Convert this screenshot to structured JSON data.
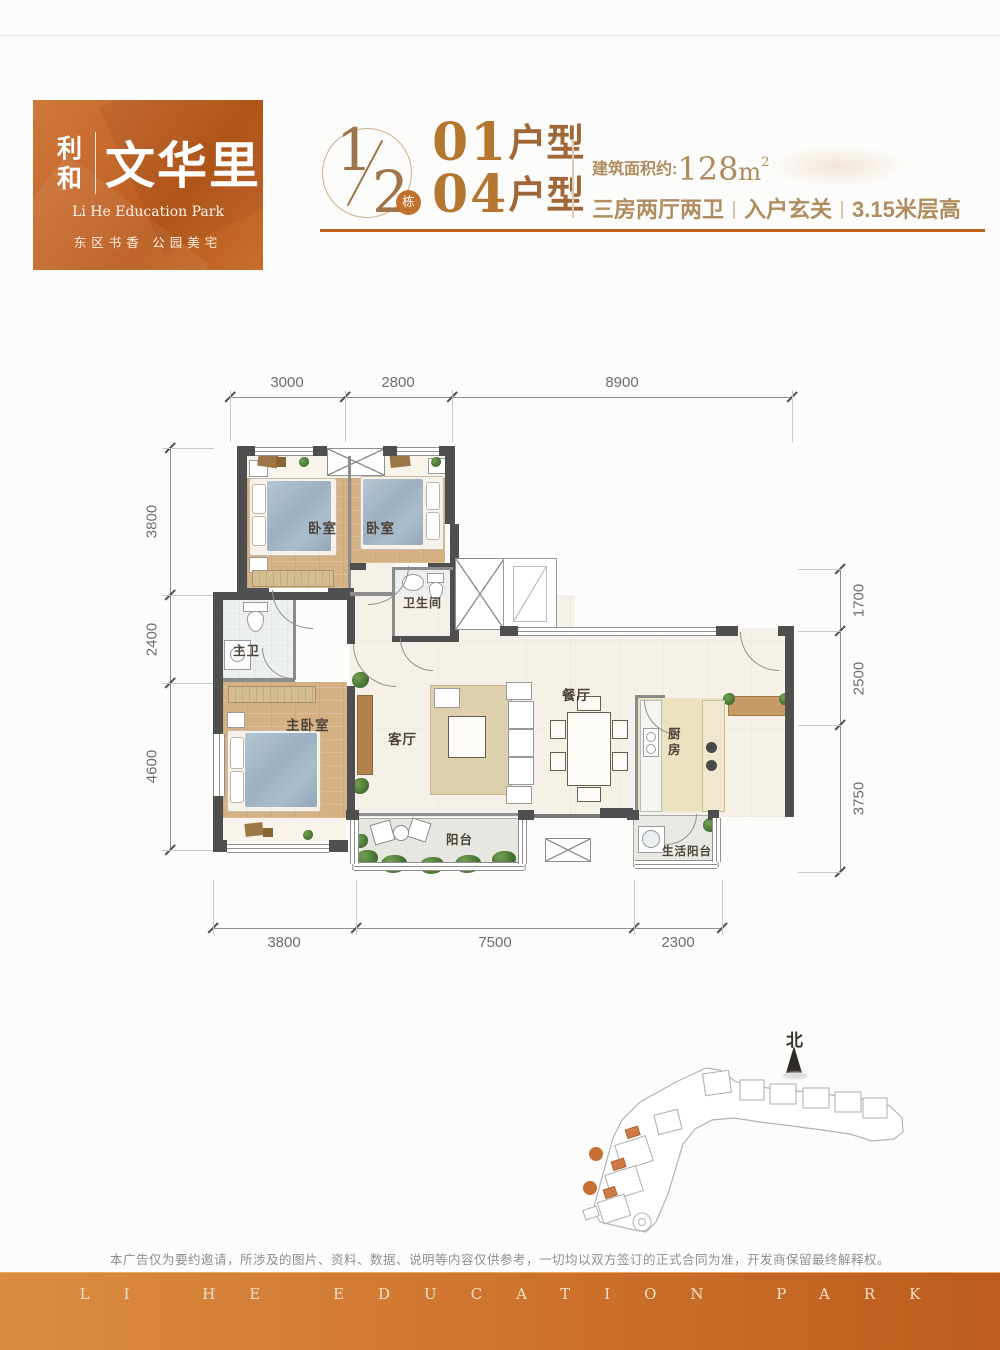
{
  "logo": {
    "brand_cn_small": "利和",
    "brand_cn_large": "文华里",
    "subtitle": "Li He Education Park",
    "tagline": "东区书香 公园美宅"
  },
  "header": {
    "building_numerator": "1",
    "building_denominator": "2",
    "building_badge": "栋",
    "unit1_no": "01",
    "unit1_suffix": "户型",
    "unit2_no": "04",
    "unit2_suffix": "户型",
    "area_label": "建筑面积约:",
    "area_value": "128",
    "area_unit": "m",
    "area_sup": "2",
    "spec1": "三房两厅两卫",
    "spec2": "入户玄关",
    "spec3": "3.15米层高"
  },
  "floorplan": {
    "dims_top": [
      "3000",
      "2800",
      "8900"
    ],
    "dims_bottom": [
      "3800",
      "7500",
      "2300"
    ],
    "dims_left": [
      "3800",
      "2400",
      "4600"
    ],
    "dims_right": [
      "1700",
      "2500",
      "3750"
    ],
    "rooms": {
      "bedroom1": "卧室",
      "bedroom2": "卧室",
      "bathroom": "卫生间",
      "master_bath": "主卫",
      "master_bedroom": "主卧室",
      "living": "客厅",
      "dining": "餐厅",
      "kitchen": "厨房",
      "balcony": "阳台",
      "service_balcony": "生活阳台"
    }
  },
  "siteplan": {
    "north": "北"
  },
  "footer": {
    "disclaimer": "本广告仅为要约邀请，所涉及的图片、资料、数据、说明等内容仅供参考，一切均以双方签订的正式合同为准，开发商保留最终解释权。",
    "banner": "LI HE EDUCATION PARK"
  },
  "colors": {
    "brand_gradient_start": "#d0793c",
    "brand_gradient_end": "#b95a1c",
    "accent_underline": "#c2641f",
    "unit_number": "#b5762f",
    "spec_text": "#b08d60",
    "wall": "#4f4f4f",
    "footer_start": "#db8d43",
    "footer_end": "#bd5c1d"
  }
}
